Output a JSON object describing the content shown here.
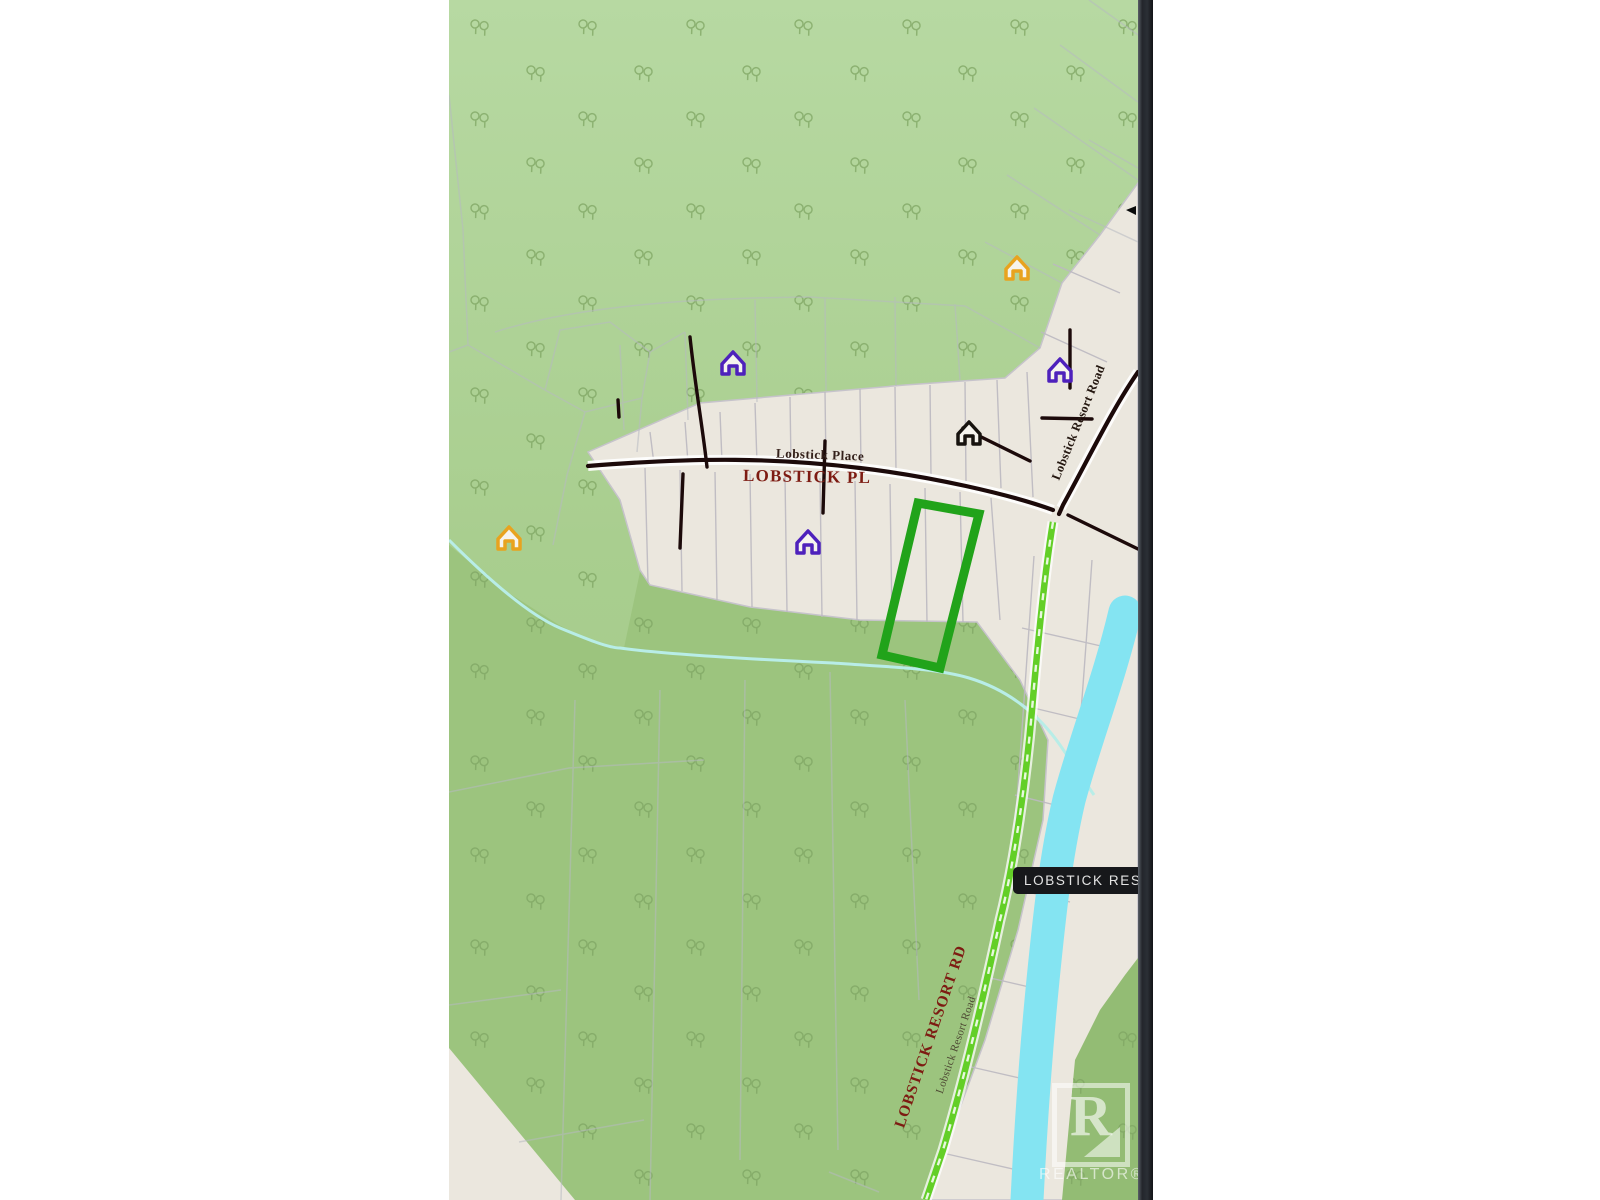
{
  "map": {
    "street_labels": {
      "lobstick_place_small": "Lobstick Place",
      "lobstick_pl": "LOBSTICK PL",
      "lobstick_resort_road_upper": "Lobstick Resort Road",
      "lobstick_resort_rd": "LOBSTICK RESORT RD",
      "lobstick_resort_road_lower": "Lobstick Resort Road"
    },
    "place_label": "LOBSTICK RESORT",
    "watermark": {
      "letter": "R",
      "brand": "REALTOR®"
    },
    "markers": [
      {
        "type": "house",
        "name": "house-orange-upper-right",
        "color": "#E8A31F"
      },
      {
        "type": "house",
        "name": "house-purple-upper-left",
        "color": "#4E21BC"
      },
      {
        "type": "house",
        "name": "house-purple-upper-right",
        "color": "#4E21BC"
      },
      {
        "type": "house",
        "name": "house-black-center",
        "color": "#17130F"
      },
      {
        "type": "house",
        "name": "house-purple-center",
        "color": "#4E21BC"
      },
      {
        "type": "house",
        "name": "house-orange-left",
        "color": "#E8A31F"
      }
    ],
    "colors": {
      "forest_upper": "#B5D8A0",
      "forest_lower": "#9CC47E",
      "parcel_beige": "#EBE7DE",
      "river_blue": "#84E4F2",
      "route_green": "#63CF27",
      "property_highlight_green": "#21A31A",
      "road_dark": "#1C0A0A",
      "road_label_red": "#7D1B12",
      "pill_background": "#17181B"
    }
  }
}
